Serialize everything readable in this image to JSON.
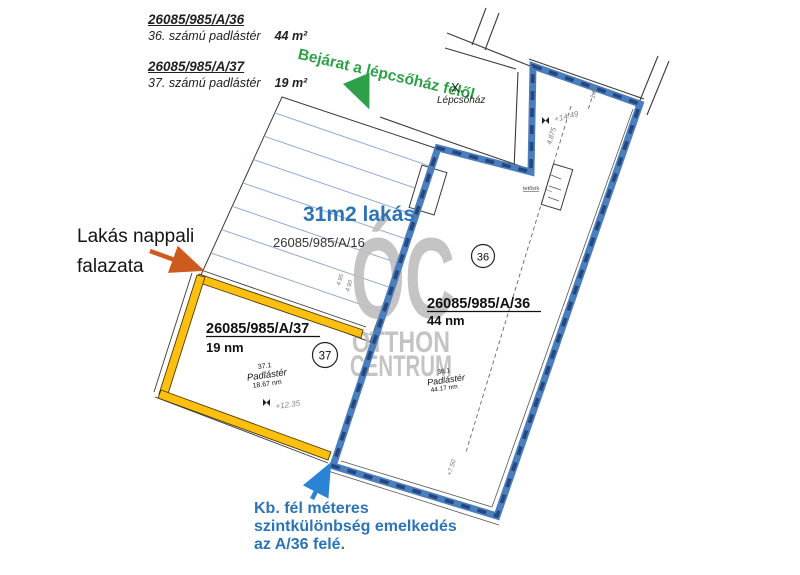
{
  "legend": {
    "items": [
      {
        "parcel": "26085/985/A/36",
        "desc": "36. számú padlástér",
        "area": "44 m²"
      },
      {
        "parcel": "26085/985/A/37",
        "desc": "37. számú padlástér",
        "area": "19 m²"
      }
    ]
  },
  "notes": {
    "entrance": "Bejárat a lépcsőház felől",
    "staircase_number": "X.",
    "staircase_label": "Lépcsőház",
    "apartment_title": "31m2 lakás",
    "apartment_parcel": "26085/985/A/16",
    "wall_line1": "Lakás nappali",
    "wall_line2": "falazata",
    "level_line1": "Kb. fél méteres",
    "level_line2": "szintkülönbség emelkedés",
    "level_line3": "az A/36 felé."
  },
  "plan": {
    "unit37": {
      "parcel": "26085/985/A/37",
      "area": "19 nm",
      "circle": "37",
      "room_no": "37.1",
      "room_name": "Padlástér",
      "room_area": "18.67 nm",
      "level": "+12.35"
    },
    "unit36": {
      "parcel": "26085/985/A/36",
      "area": "44 nm",
      "circle": "36",
      "room_no": "36.1",
      "room_name": "Padlástér",
      "room_area": "44.17 nm",
      "level": "+14.49"
    },
    "dims": {
      "d1": "4.875",
      "d2": "1.82",
      "d3": "+7.50",
      "d4": "4.95",
      "d5": "4.90"
    },
    "box_label": "tetősík"
  },
  "watermark": {
    "logo": "ÓC",
    "line1": "OTTHON",
    "line2": "CENTRUM"
  },
  "colors": {
    "wall_blue": "#4a7ebc",
    "wall_blue_dash": "#26477e",
    "wall_yellow": "#fdc010",
    "hatch_blue": "#90a8cf",
    "note_green": "#2ea049",
    "note_blue": "#2e74b5",
    "arrow_orange": "#cd5b1e",
    "arrow_blue": "#2b83d6",
    "watermark_gray": "#c0c0c0"
  }
}
